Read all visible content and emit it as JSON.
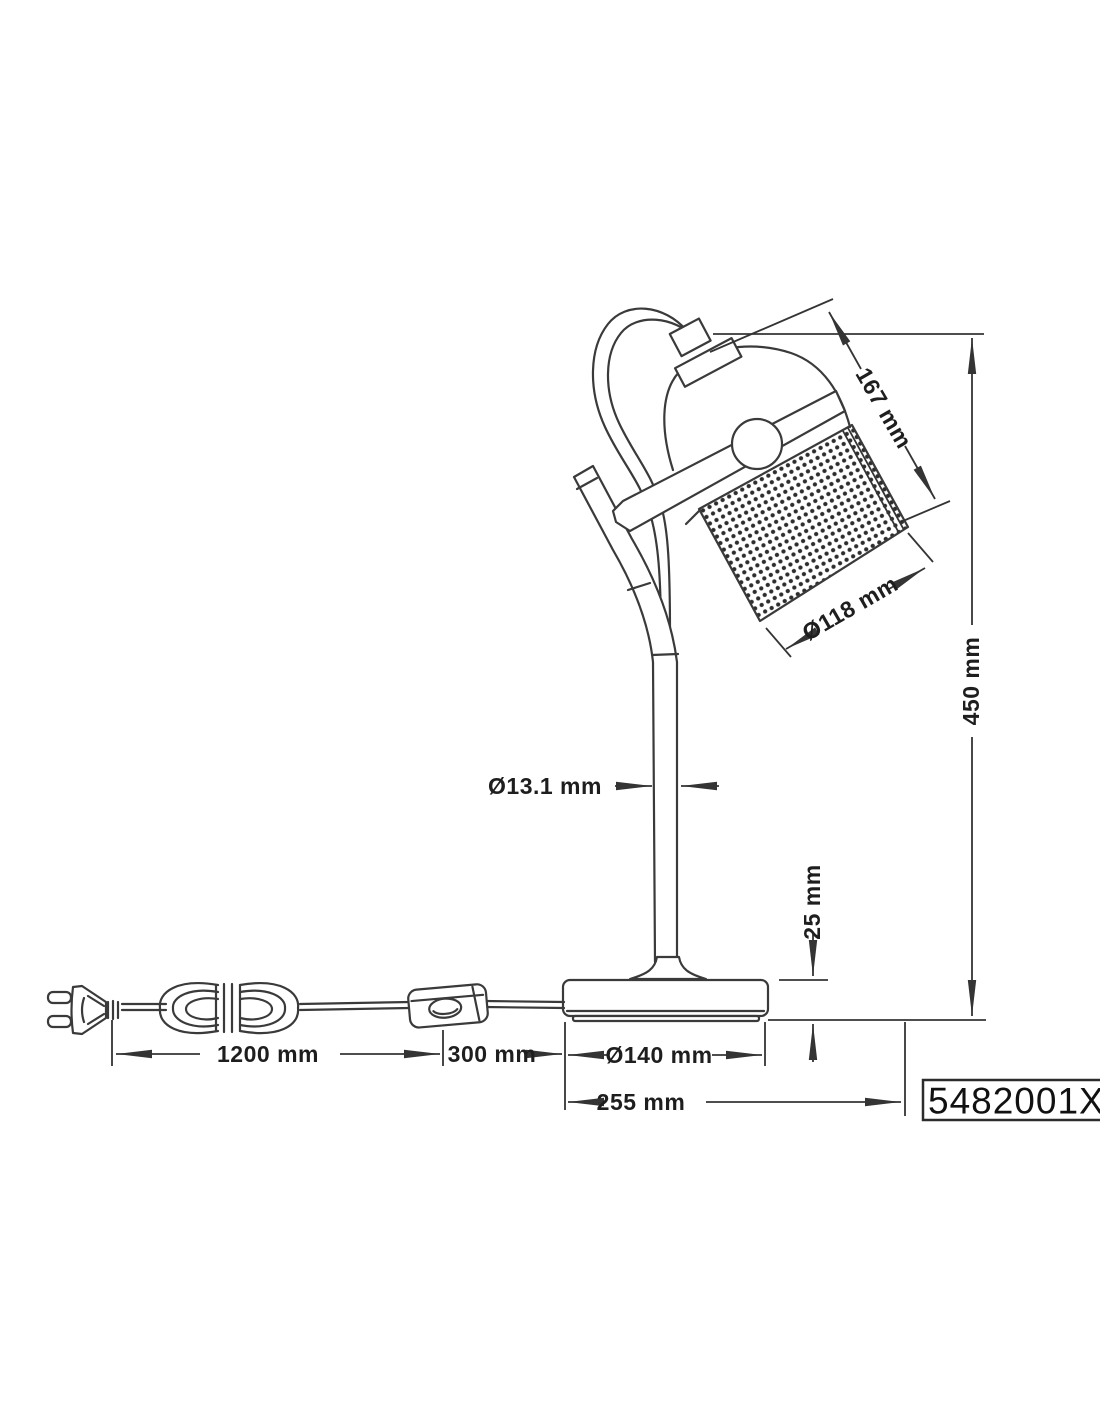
{
  "page": {
    "background": "#ffffff",
    "line_color": "#3a3a3a",
    "text_color": "#1e1e1e"
  },
  "drawing": {
    "part_number": "5482001XX",
    "dimensions": {
      "head_length": "167 mm",
      "shade_diameter": "Ø118 mm",
      "total_height": "450 mm",
      "pole_diameter": "Ø13.1 mm",
      "base_height": "25 mm",
      "cord_length": "1200 mm",
      "switch_distance": "300 mm",
      "base_diameter": "Ø140 mm",
      "overall_depth": "255 mm"
    }
  }
}
